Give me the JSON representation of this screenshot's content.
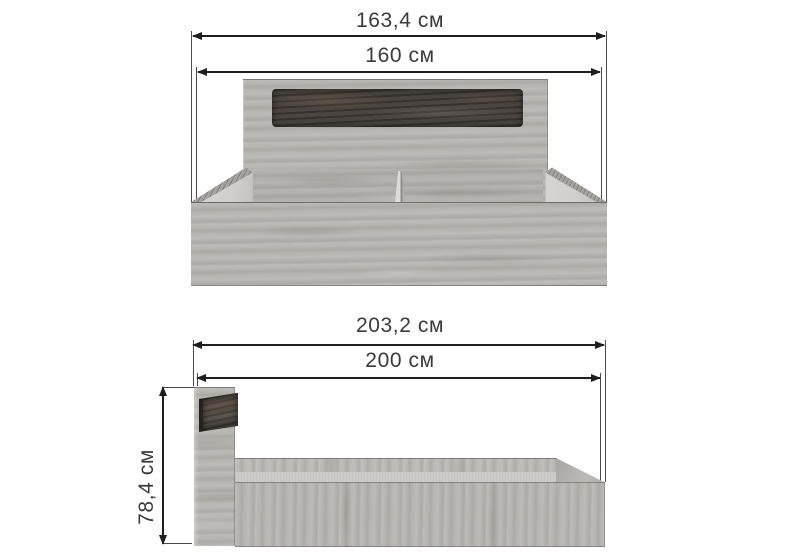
{
  "front_view": {
    "overall_width_label": "163,4 см",
    "inner_width_label": "160 см"
  },
  "side_view": {
    "overall_length_label": "203,2 см",
    "inner_length_label": "200 см",
    "height_label": "78,4 см"
  },
  "colors": {
    "background": "#ffffff",
    "line": "#1e1e1e",
    "text": "#3a3a3a",
    "wood_base": "#b7b5b1",
    "wood_light": "#cac8c4",
    "wood_streak": "#9b9995",
    "insert_dark": "#4a4540",
    "rail_inner": "#d0cfcd",
    "platform": "#cdccca"
  }
}
